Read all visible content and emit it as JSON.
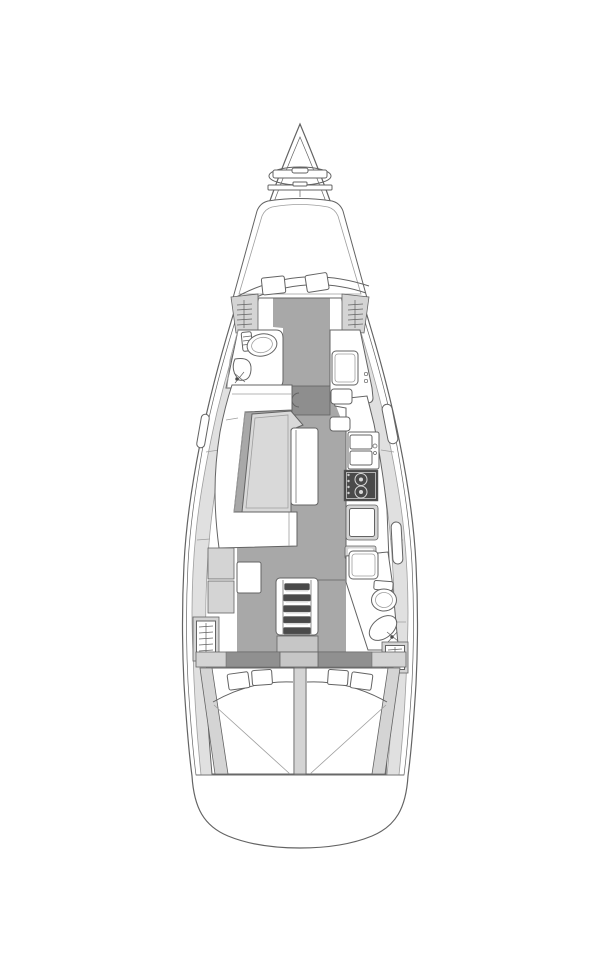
{
  "page": {
    "background": "#ffffff"
  },
  "colors": {
    "white": "#ffffff",
    "outline": "#636363",
    "outline_light": "#9e9e9e",
    "floor": "#a8a8a8",
    "mast_block": "#8e8e8e",
    "band_dark": "#909090",
    "panel": "#d4d4d4",
    "panel_light": "#e0e0e0",
    "table": "#d9d9d9",
    "engine_panel": "#c6c6c6",
    "dark": "#4a4a4a"
  },
  "diagram": {
    "type": "boat-floor-plan",
    "subject": "sailing-yacht-interior-layout-top-view",
    "features": [
      "bow-anchor-locker-hatch",
      "windlass",
      "foredeck-hatch",
      "forward-cabin-v-berth",
      "forward-berth-pillows",
      "forward-hanging-lockers",
      "forward-head-toilet",
      "forward-head-sink",
      "starboard-wardrobe",
      "mast-post",
      "salon-l-settee",
      "salon-table",
      "salon-table-leaf",
      "galley-counter",
      "galley-double-sink",
      "galley-stove-two-burner",
      "galley-fridge",
      "nav-station-cabinets",
      "nav-station-desk",
      "companionway-ladder-5-steps",
      "engine-compartment",
      "aft-head-shower",
      "aft-head-toilet",
      "aft-head-sink",
      "aft-hanging-lockers",
      "aft-cabin-port-double-berth",
      "aft-cabin-starboard-double-berth",
      "aft-berth-pillows",
      "transom"
    ]
  }
}
